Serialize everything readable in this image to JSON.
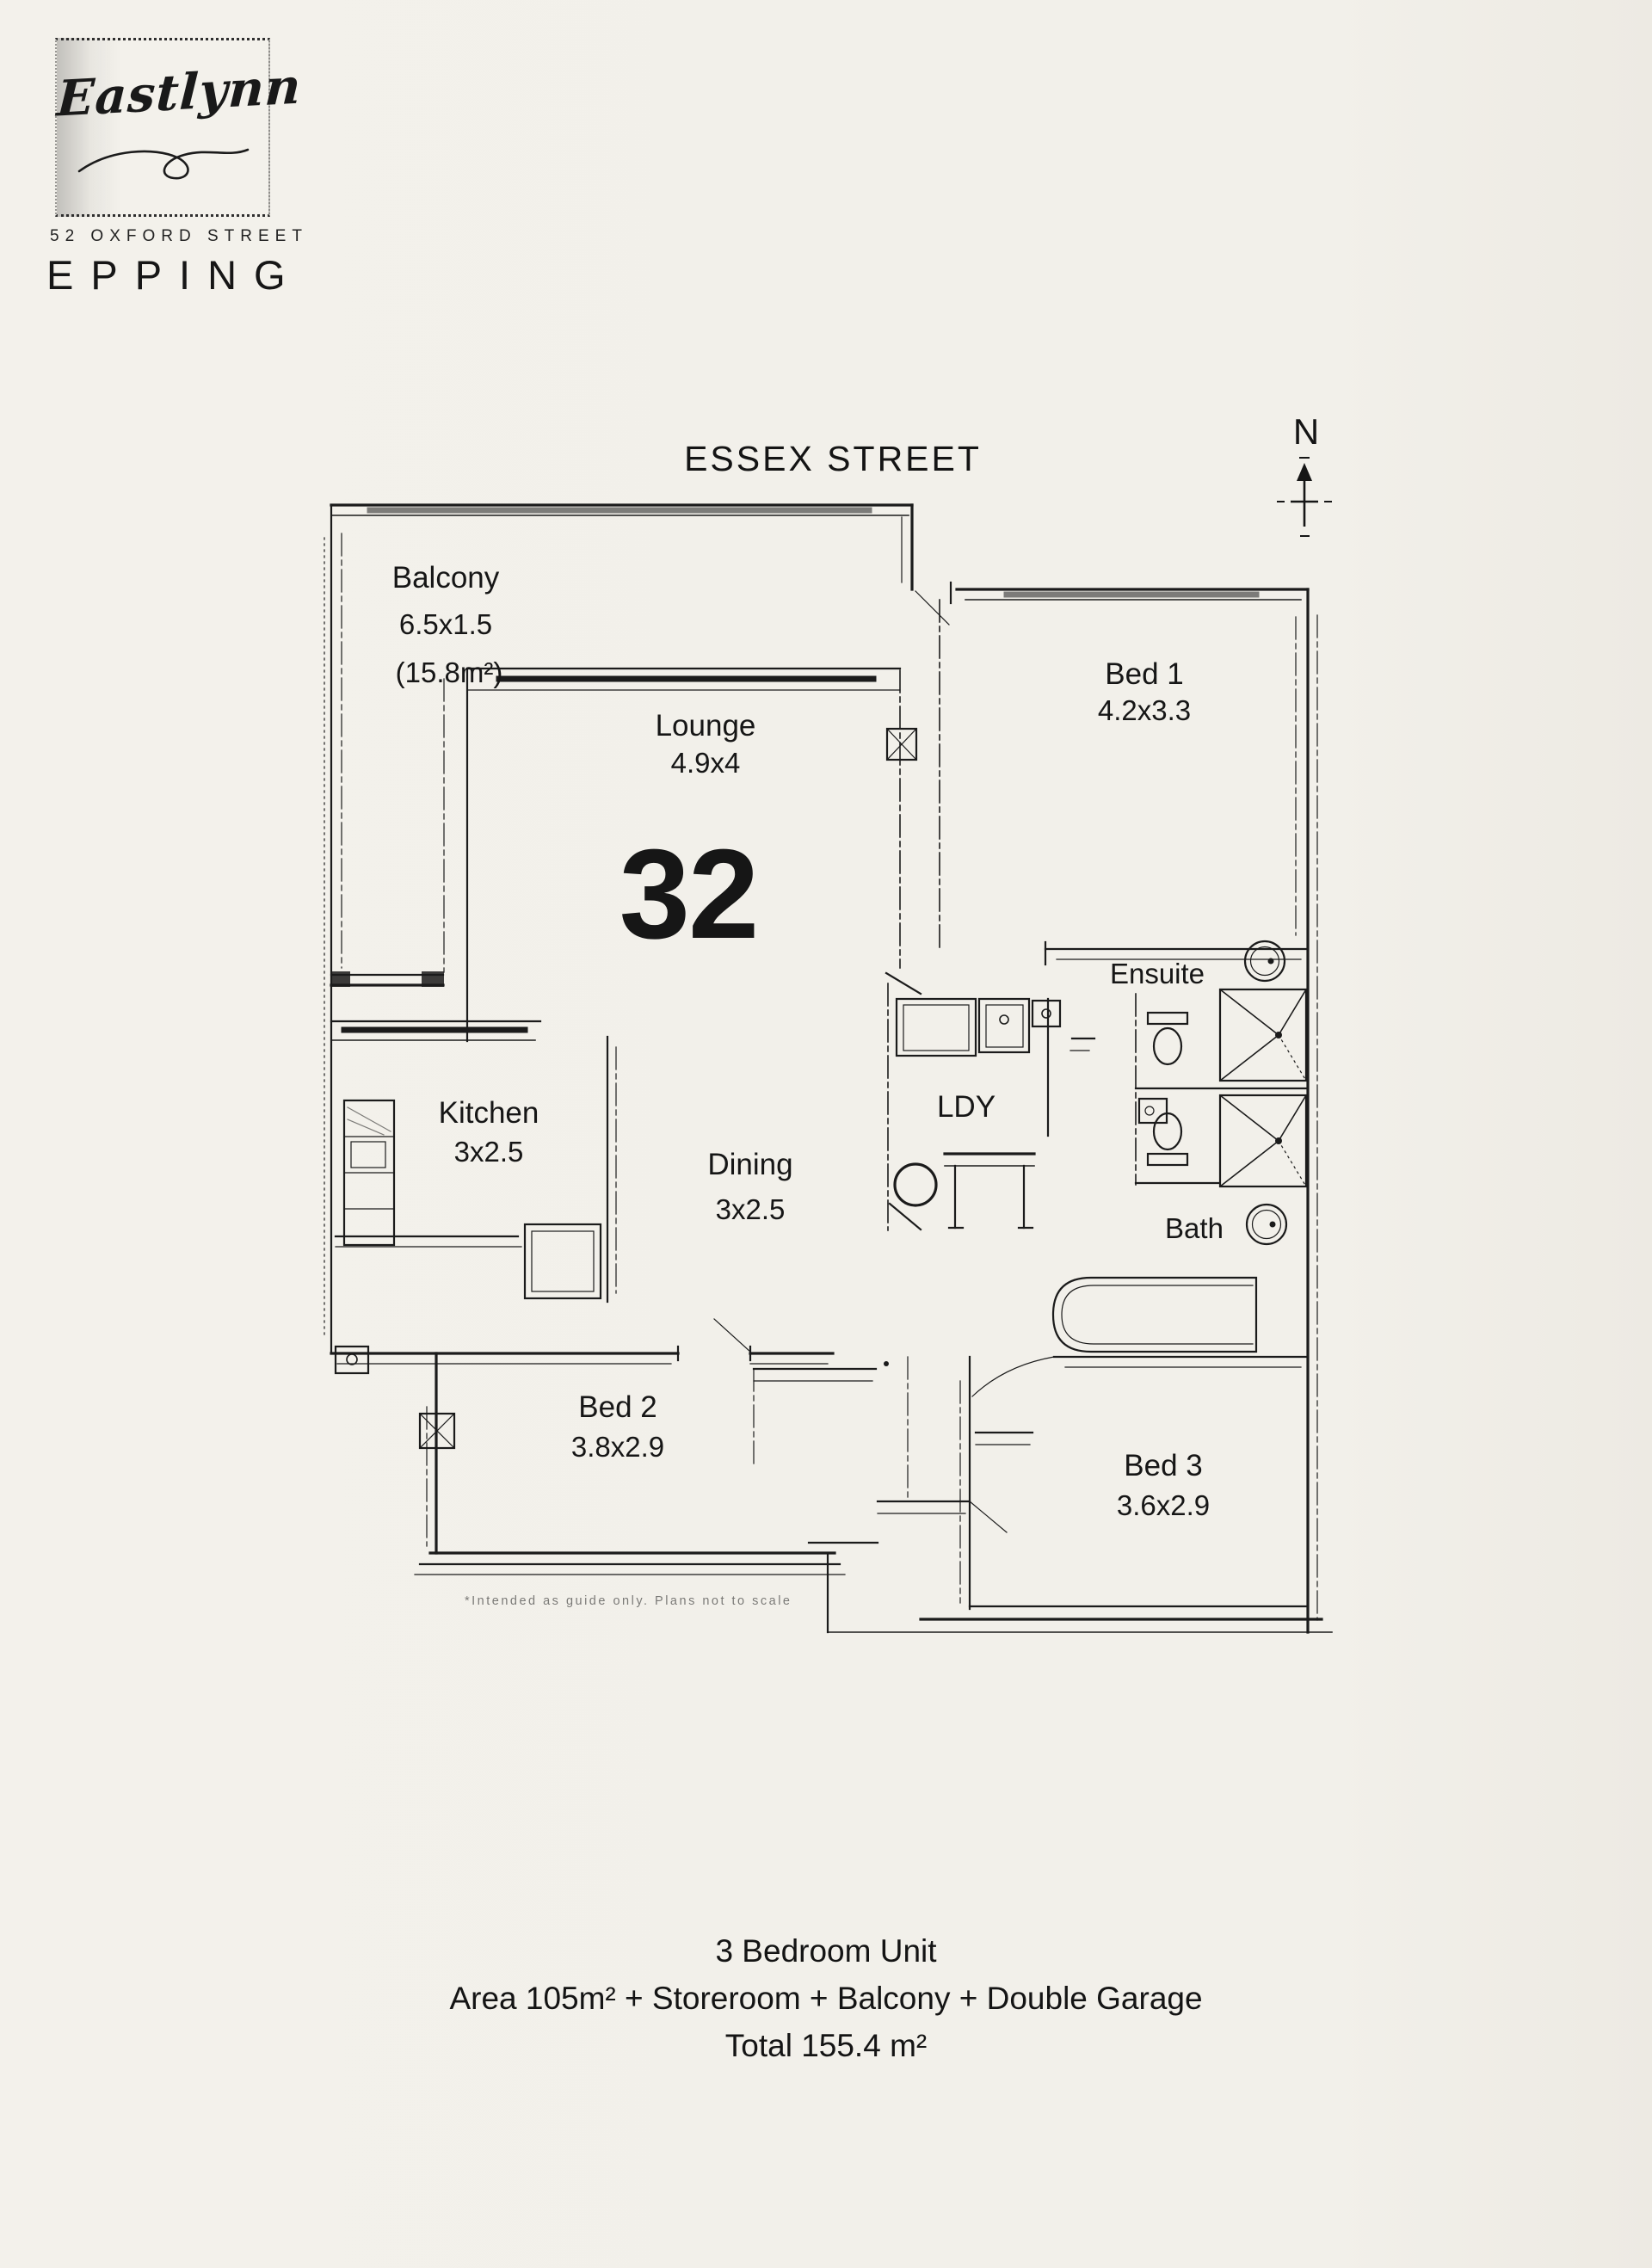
{
  "letterhead": {
    "name": "Eastlynn",
    "address": "52 OXFORD STREET",
    "suburb": "EPPING"
  },
  "compass": {
    "north": "N"
  },
  "plan": {
    "street": "ESSEX STREET",
    "unit_number": "32",
    "disclaimer": "*Intended as guide only. Plans not to scale",
    "rooms": {
      "balcony": {
        "name": "Balcony",
        "dims": "6.5x1.5",
        "area": "(15.8m²)"
      },
      "lounge": {
        "name": "Lounge",
        "dims": "4.9x4"
      },
      "bed1": {
        "name": "Bed 1",
        "dims": "4.2x3.3"
      },
      "ensuite": {
        "name": "Ensuite"
      },
      "kitchen": {
        "name": "Kitchen",
        "dims": "3x2.5"
      },
      "dining": {
        "name": "Dining",
        "dims": "3x2.5"
      },
      "laundry": {
        "name": "LDY"
      },
      "bath": {
        "name": "Bath"
      },
      "bed2": {
        "name": "Bed 2",
        "dims": "3.8x2.9"
      },
      "bed3": {
        "name": "Bed 3",
        "dims": "3.6x2.9"
      }
    }
  },
  "summary": {
    "line1": "3 Bedroom Unit",
    "line2": "Area 105m² + Storeroom + Balcony + Double Garage",
    "line3": "Total 155.4 m²"
  },
  "colors": {
    "paper": "#f2f0ea",
    "ink": "#1b1b1b"
  }
}
